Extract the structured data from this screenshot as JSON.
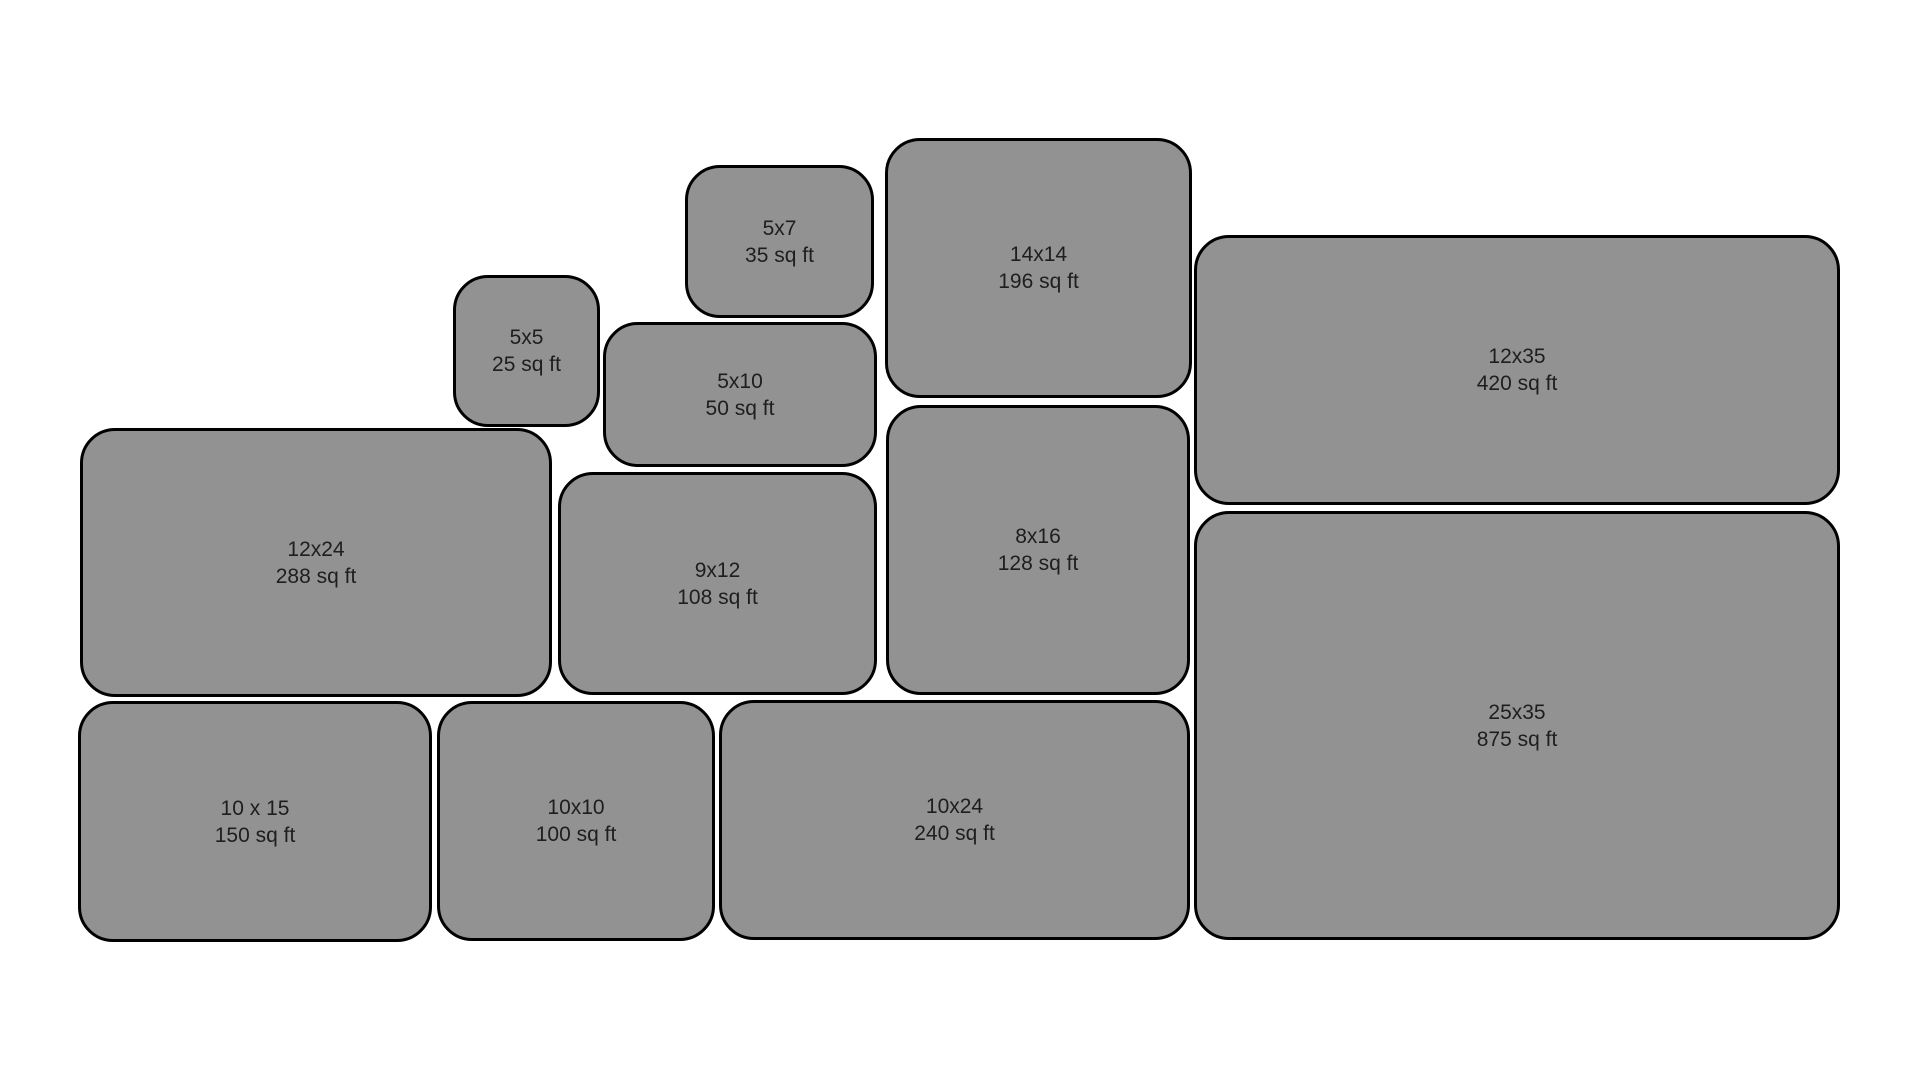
{
  "diagram": {
    "description": "Storage unit size comparison diagram",
    "background_color": "#ffffff",
    "box_fill_color": "#929292",
    "box_border_color": "#000000",
    "text_color": "#1e1e1e"
  },
  "units": [
    {
      "id": "5x7",
      "size": "5x7",
      "area": "35 sq ft",
      "rect": {
        "x": 685,
        "y": 165,
        "w": 189,
        "h": 153
      }
    },
    {
      "id": "14x14",
      "size": "14x14",
      "area": "196 sq ft",
      "rect": {
        "x": 885,
        "y": 138,
        "w": 307,
        "h": 260
      }
    },
    {
      "id": "12x35",
      "size": "12x35",
      "area": "420 sq ft",
      "rect": {
        "x": 1194,
        "y": 235,
        "w": 646,
        "h": 270
      }
    },
    {
      "id": "5x5",
      "size": "5x5",
      "area": "25 sq ft",
      "rect": {
        "x": 453,
        "y": 275,
        "w": 147,
        "h": 152
      }
    },
    {
      "id": "5x10",
      "size": "5x10",
      "area": "50 sq ft",
      "rect": {
        "x": 603,
        "y": 322,
        "w": 274,
        "h": 145
      }
    },
    {
      "id": "12x24",
      "size": "12x24",
      "area": "288 sq ft",
      "rect": {
        "x": 80,
        "y": 428,
        "w": 472,
        "h": 269
      }
    },
    {
      "id": "9x12",
      "size": "9x12",
      "area": "108 sq ft",
      "rect": {
        "x": 558,
        "y": 472,
        "w": 319,
        "h": 223
      }
    },
    {
      "id": "8x16",
      "size": "8x16",
      "area": "128 sq ft",
      "rect": {
        "x": 886,
        "y": 405,
        "w": 304,
        "h": 290
      }
    },
    {
      "id": "25x35",
      "size": "25x35",
      "area": "875 sq ft",
      "rect": {
        "x": 1194,
        "y": 511,
        "w": 646,
        "h": 429
      }
    },
    {
      "id": "10x15",
      "size": "10 x 15",
      "area": "150 sq ft",
      "rect": {
        "x": 78,
        "y": 701,
        "w": 354,
        "h": 241
      }
    },
    {
      "id": "10x10",
      "size": "10x10",
      "area": "100 sq ft",
      "rect": {
        "x": 437,
        "y": 701,
        "w": 278,
        "h": 240
      }
    },
    {
      "id": "10x24",
      "size": "10x24",
      "area": "240 sq ft",
      "rect": {
        "x": 719,
        "y": 700,
        "w": 471,
        "h": 240
      }
    }
  ]
}
